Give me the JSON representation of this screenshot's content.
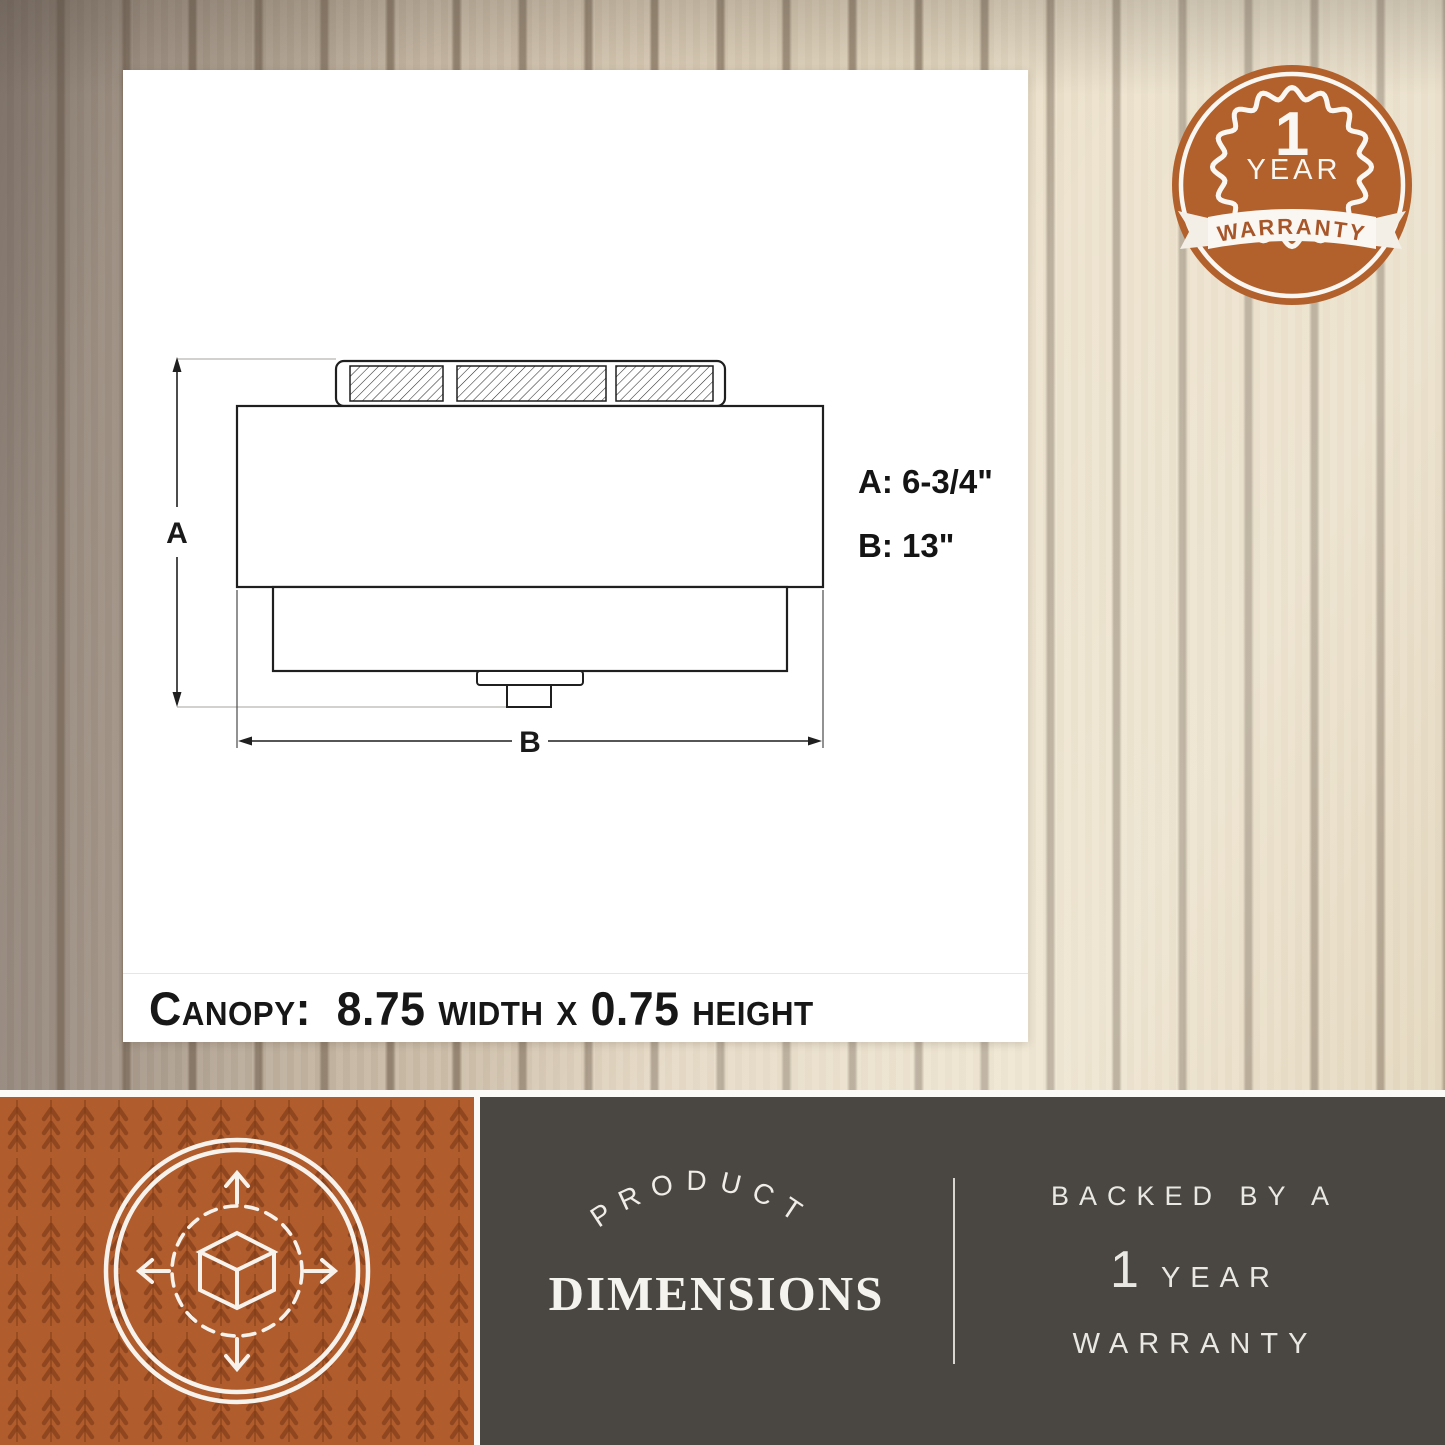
{
  "colors": {
    "accent_orange": "#b05c2c",
    "badge_orange": "#b2612c",
    "panel_dark": "#4a4743",
    "drawing_line": "#1f1f1f",
    "wood_light": "#e8dcc4",
    "wood_dark_groove": "#5c4a38"
  },
  "drawing": {
    "dim_letter_a": "A",
    "dim_letter_b": "B",
    "dim_a_value": "A: 6-3/4\"",
    "dim_b_value": "B: 13\"",
    "canopy_note": "Canopy:  8.75 width x 0.75 height"
  },
  "badge": {
    "line1": "1",
    "line2": "YEAR",
    "ribbon": "WARRANTY"
  },
  "footer": {
    "left_icon": "3d-cube-dimensions-icon",
    "product": "PRODUCT",
    "dimensions": "DIMENSIONS",
    "backed_by": "BACKED BY A",
    "year_number": "1",
    "year_word": "YEAR",
    "warranty_word": "WARRANTY"
  }
}
